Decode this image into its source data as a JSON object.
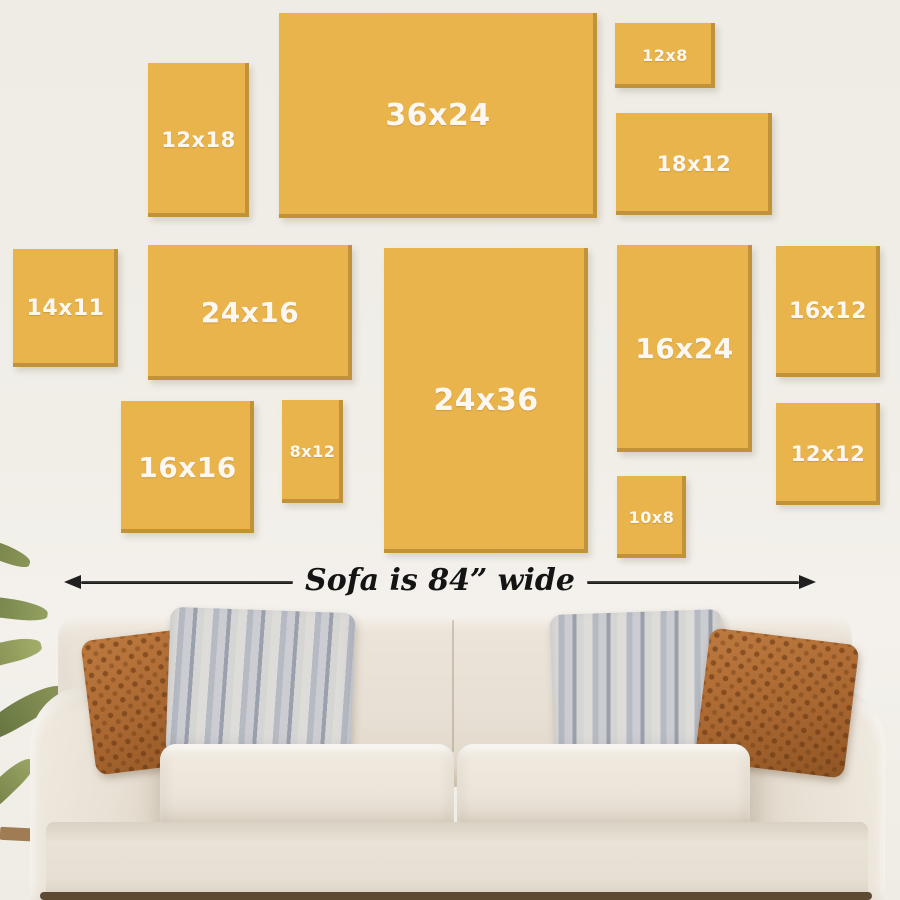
{
  "colors": {
    "wall_background": "#F0EDE8",
    "canvas_gold": "#E9B44C",
    "canvas_edge_shadow": "#926826",
    "label_text": "#FCF8F1",
    "arrow_and_text": "#1F1F1F",
    "sofa_fabric": "#E9E2D7",
    "pillow_rust": "#AE6C33",
    "pillow_stripe_gray": "#B6BAC3",
    "plant_green": "#7A8749"
  },
  "frames": [
    {
      "label": "12x18",
      "left": 148,
      "top": 63,
      "width": 101,
      "height": 154
    },
    {
      "label": "36x24",
      "left": 279,
      "top": 13,
      "width": 318,
      "height": 205
    },
    {
      "label": "12x8",
      "left": 615,
      "top": 23,
      "width": 100,
      "height": 65
    },
    {
      "label": "18x12",
      "left": 616,
      "top": 113,
      "width": 156,
      "height": 102
    },
    {
      "label": "14x11",
      "left": 13,
      "top": 249,
      "width": 105,
      "height": 118
    },
    {
      "label": "24x16",
      "left": 148,
      "top": 245,
      "width": 204,
      "height": 135
    },
    {
      "label": "24x36",
      "left": 384,
      "top": 248,
      "width": 204,
      "height": 305
    },
    {
      "label": "16x24",
      "left": 617,
      "top": 245,
      "width": 135,
      "height": 207
    },
    {
      "label": "16x12",
      "left": 776,
      "top": 246,
      "width": 104,
      "height": 131
    },
    {
      "label": "16x16",
      "left": 121,
      "top": 401,
      "width": 133,
      "height": 132
    },
    {
      "label": "8x12",
      "left": 282,
      "top": 400,
      "width": 61,
      "height": 103
    },
    {
      "label": "10x8",
      "left": 617,
      "top": 476,
      "width": 69,
      "height": 82
    },
    {
      "label": "12x12",
      "left": 776,
      "top": 403,
      "width": 104,
      "height": 102
    }
  ],
  "arrow": {
    "text": "Sofa is 84” wide"
  }
}
